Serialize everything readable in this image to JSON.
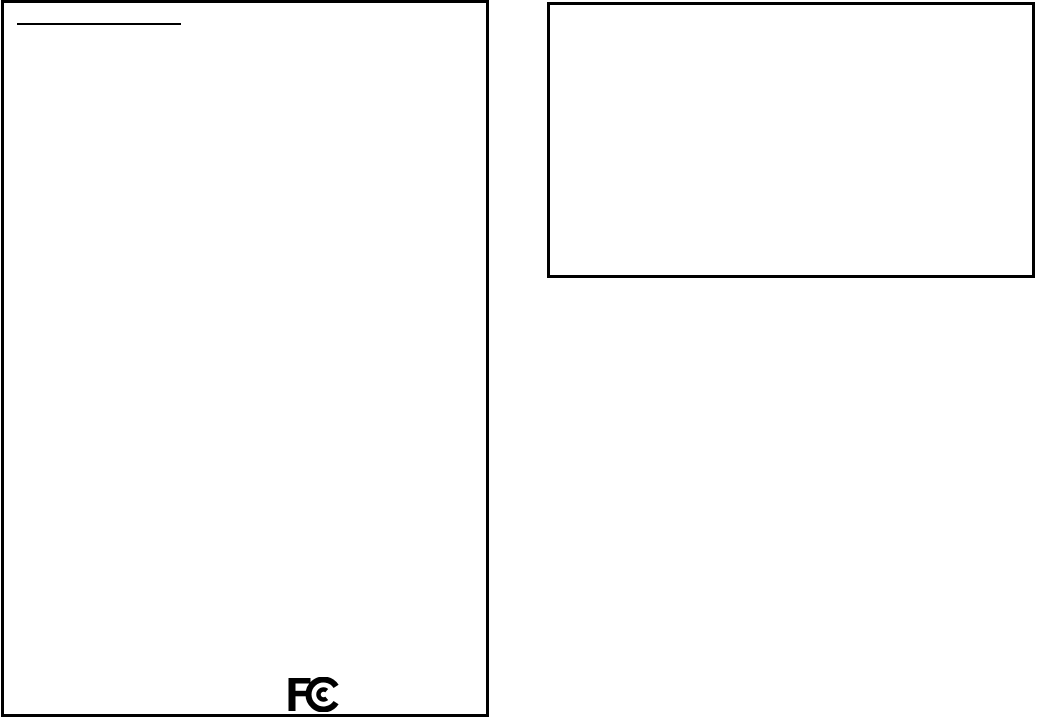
{
  "page": {
    "background_color": "#ffffff",
    "ink_color": "#000000"
  },
  "logo": {
    "name": "fcc-logo",
    "reads_as": "FCC",
    "color": "#000000"
  }
}
